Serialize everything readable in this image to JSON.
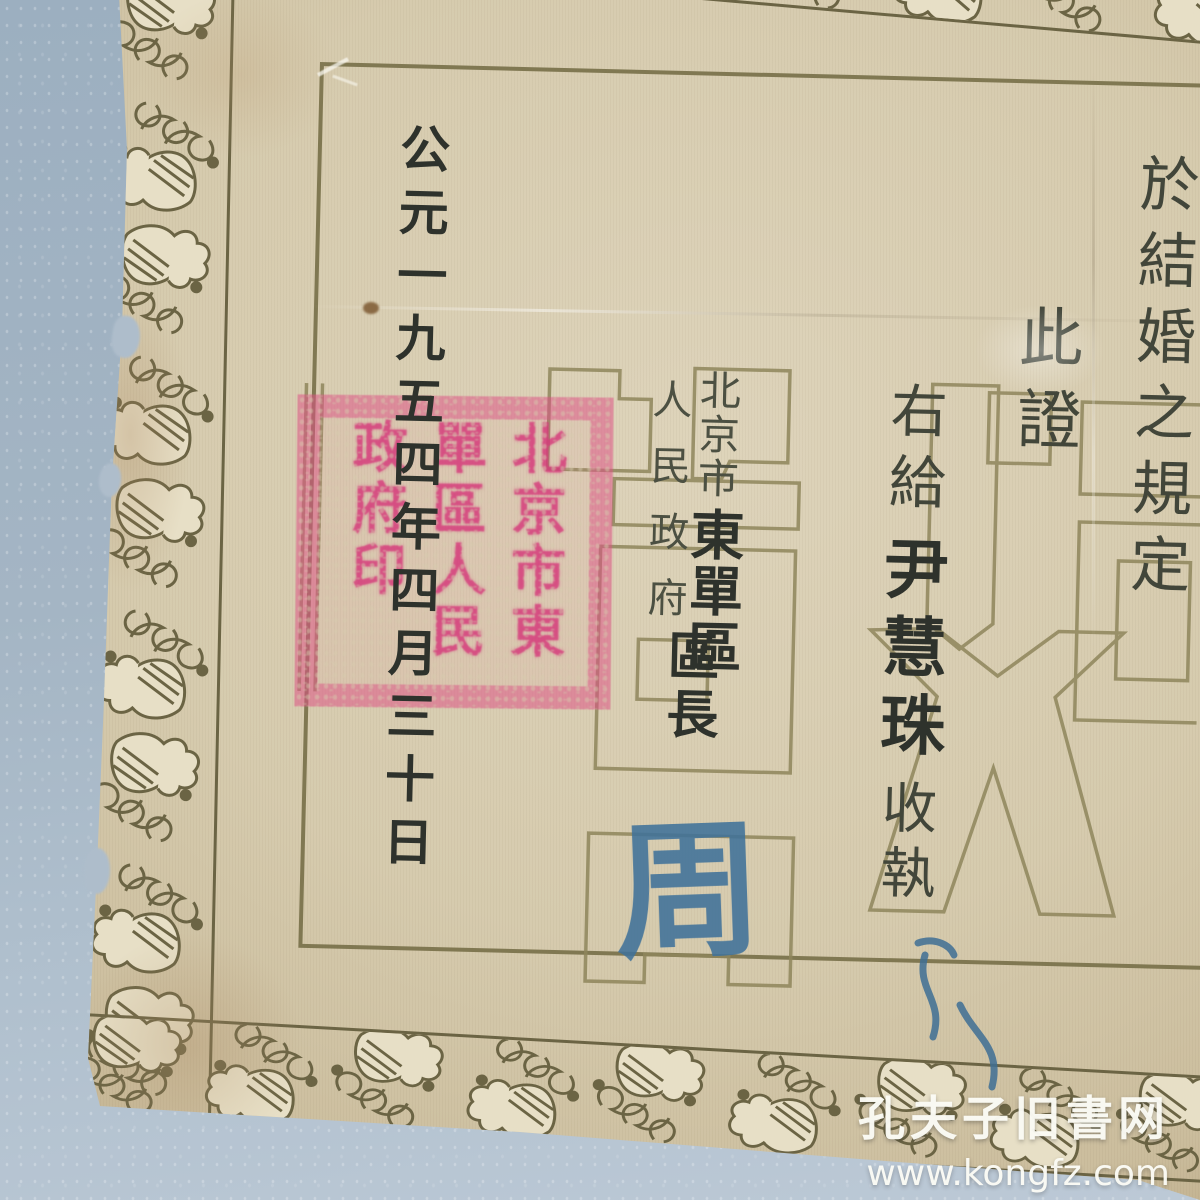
{
  "photo": {
    "backdrop_color": "#a4b4c3",
    "site_watermark": {
      "site_name": "孔夫子旧書网",
      "site_url": "www.kongfz.com"
    }
  },
  "certificate": {
    "paper_color": "#d6cbae",
    "border_ink": "#6b6444",
    "printed_ink": "#42463a",
    "handwriting_ink": "#2e322c",
    "blue_ink": "#40729a",
    "seal_red": "#dd4f86",
    "text": {
      "clause": "於結婚之規定",
      "this_cert": "此證",
      "give_prefix": "右給",
      "recipient_name": "尹慧珠",
      "give_suffix": "收執",
      "authority_city": "北京市",
      "authority_district": "東單區",
      "authority_government": "人民政府",
      "signer_title": "區長",
      "signature": "周",
      "date": "公元一九五四年四月三十日"
    },
    "seal_text": {
      "col1": "北京市東",
      "col2": "單區人民",
      "col3": "政府印"
    }
  }
}
